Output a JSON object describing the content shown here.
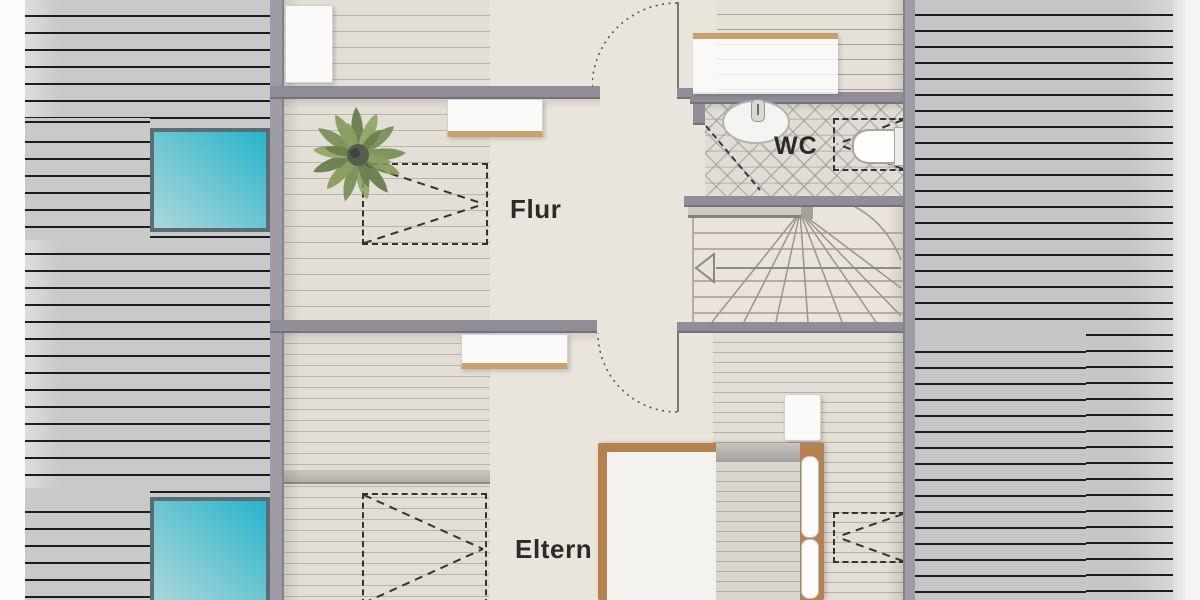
{
  "plan": {
    "type": "floor-plan-top-view",
    "rooms": [
      {
        "id": "flur",
        "label": "Flur"
      },
      {
        "id": "wc",
        "label": "WC"
      },
      {
        "id": "eltern",
        "label": "Eltern"
      }
    ],
    "labels": {
      "flur": "Flur",
      "wc": "WC",
      "eltern": "Eltern"
    },
    "features": [
      "left-roof-with-two-skylights",
      "right-roof",
      "winder-staircase",
      "toilet",
      "washbasin",
      "double-bed",
      "potted-plant",
      "roof-window-dashed-markers",
      "door-swing-arcs",
      "stair-direction-arrow"
    ],
    "colors": {
      "roof": "#c9c9c9",
      "roof_line": "#1c1c1c",
      "skylight_dark": "#27b4cc",
      "skylight_light": "#abd6db",
      "wall": "#8f8d95",
      "floor": "#eae5dc",
      "plank_line": "#b9b5ac",
      "bed_wood": "#b5814e",
      "furniture_wood": "#c9a26b",
      "dash": "#333333",
      "text": "#2a2a2a"
    }
  }
}
